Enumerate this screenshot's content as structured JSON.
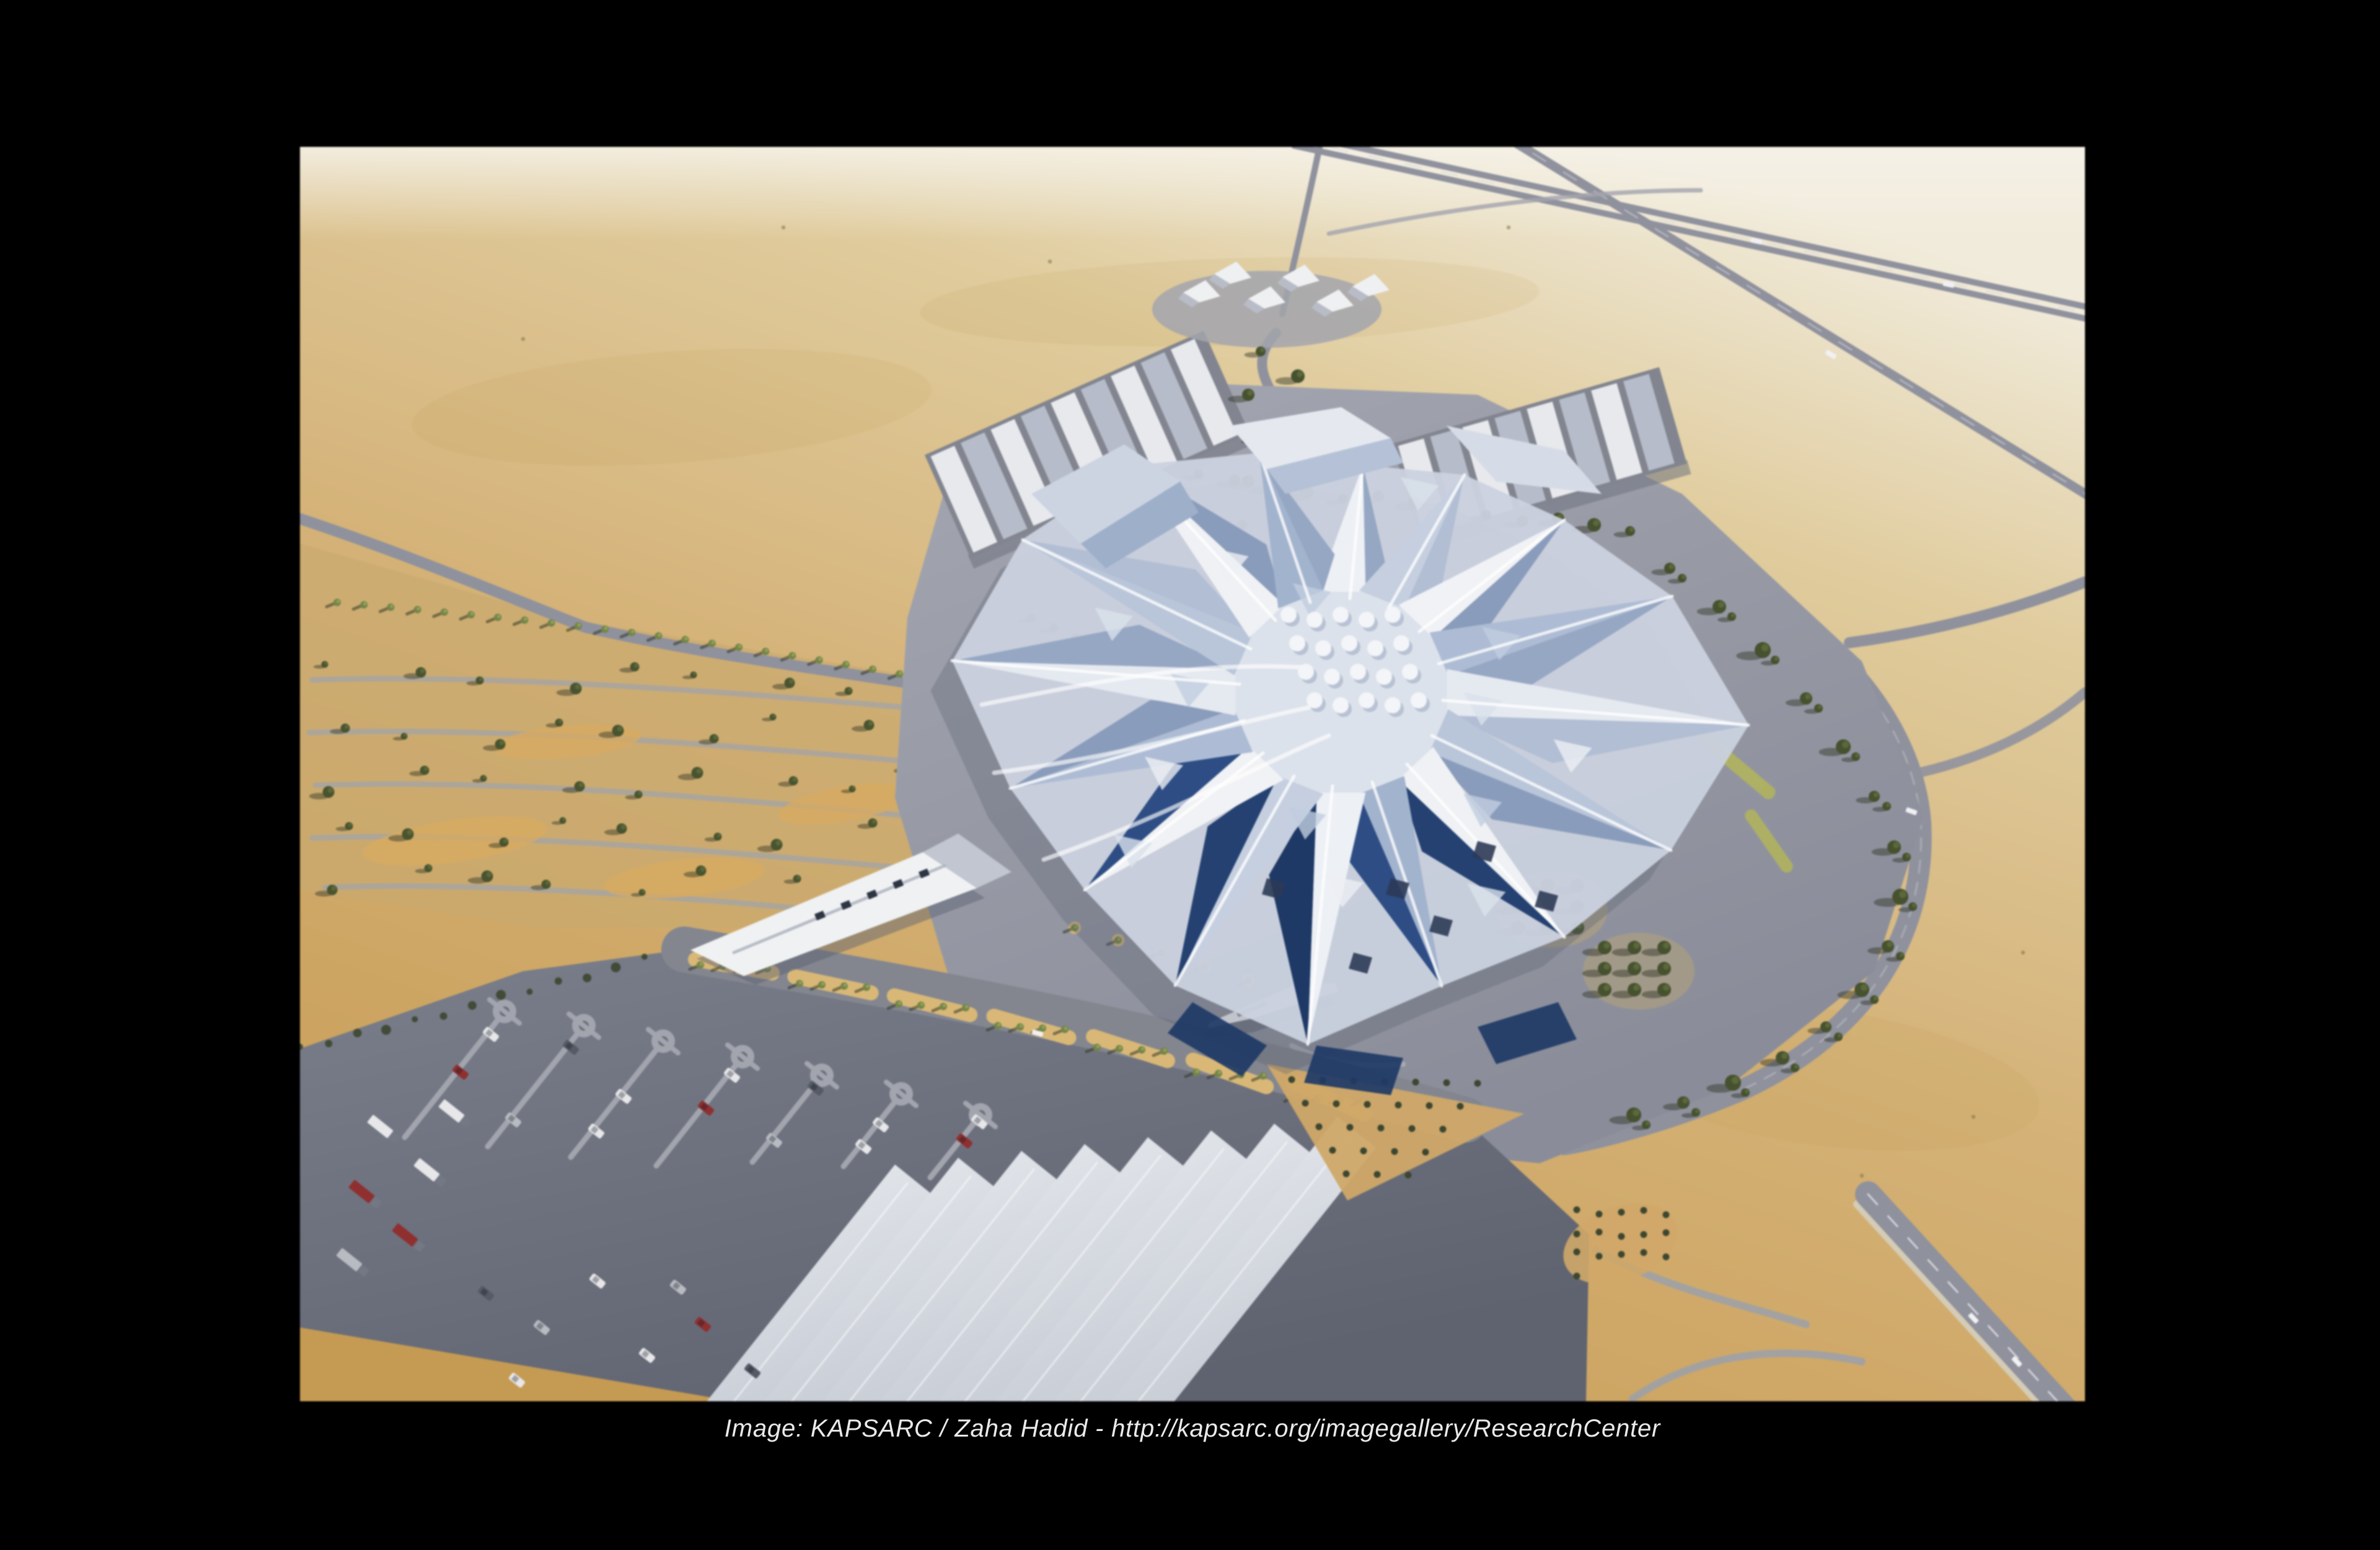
{
  "slide": {
    "caption": "Image: KAPSARC / Zaha Hadid - http://kapsarc.org/imagegallery/ResearchCenter"
  },
  "image": {
    "subject": "aerial-rendering-of-kapsarc-research-center",
    "elements": [
      "crystalline-faceted-building",
      "desert-sand",
      "highways",
      "parking-lot-with-canopies",
      "palm-lined-boulevard",
      "wadi-garden-with-trees",
      "striped-canopy-structures",
      "tent-structures",
      "wedge-building",
      "drop-off-canopy"
    ]
  },
  "palette": {
    "slide-bg": "#000000",
    "caption-text": "#eaeaea",
    "sand-haze": "#f2ecdd",
    "sand-light": "#e0cda0",
    "sand-mid": "#d4b278",
    "sand-deep": "#c79e58",
    "road-gray": "#8f919d",
    "asphalt-dark": "#5f636f",
    "asphalt-light": "#7b7f8b",
    "divider-gray": "#a2a5ae",
    "canopy-white": "#eef0f3",
    "canopy-shade": "#c2c8d2",
    "building-white": "#f1f3f6",
    "building-blue-light": "#c3cede",
    "building-blue": "#9fb2cf",
    "building-navy": "#223e6d",
    "tree-dark": "#46502f",
    "palm-green": "#75854a",
    "median-tan": "#d9b97a"
  }
}
